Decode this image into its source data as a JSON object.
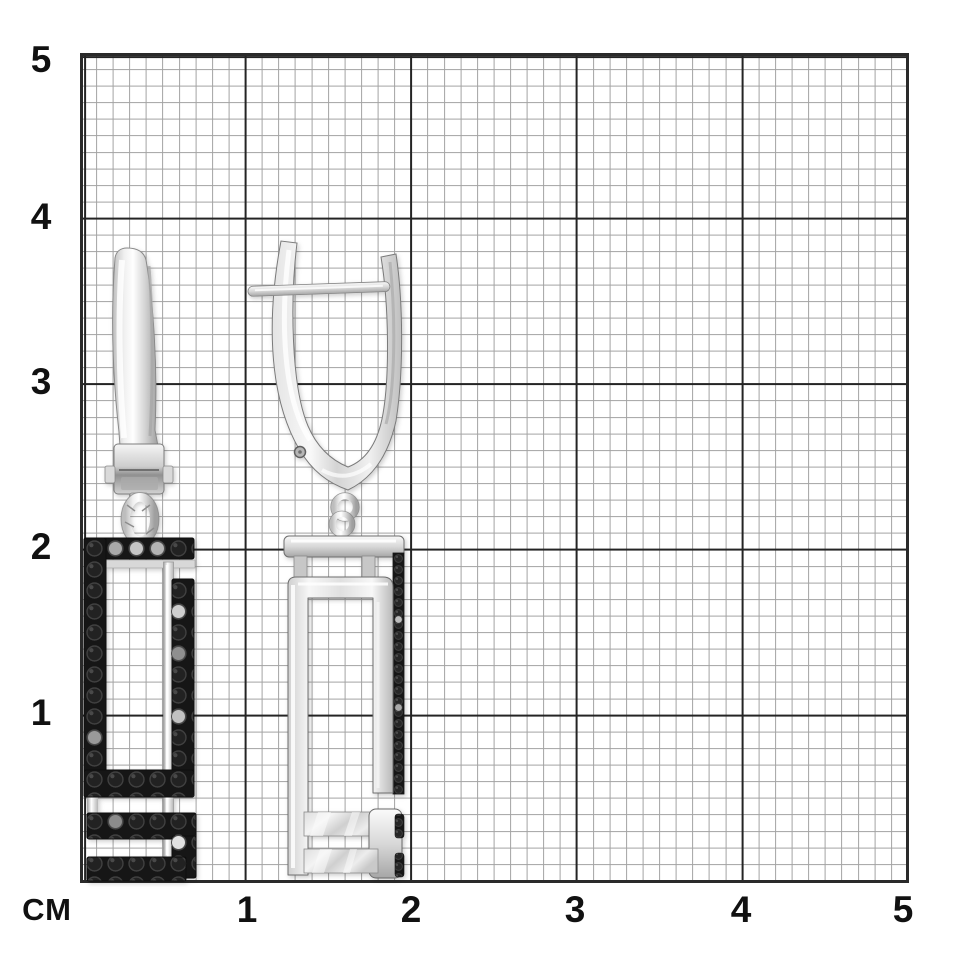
{
  "ruler": {
    "unit_label": "СМ",
    "left_labels": [
      "5",
      "4",
      "3",
      "2",
      "1"
    ],
    "bottom_labels": [
      "1",
      "2",
      "3",
      "4",
      "5"
    ],
    "colors": {
      "background": "#ffffff",
      "minor_line": "#a3a3a3",
      "major_line": "#242424",
      "border": "#2a2a2a",
      "label_text": "#111111"
    },
    "minor_divisions_per_cm": 10
  },
  "photo": {
    "subject": "pair-of-silver-earrings-with-black-pave-stones",
    "metal_color": "#d9d9d9",
    "stone_color": "#161616"
  }
}
